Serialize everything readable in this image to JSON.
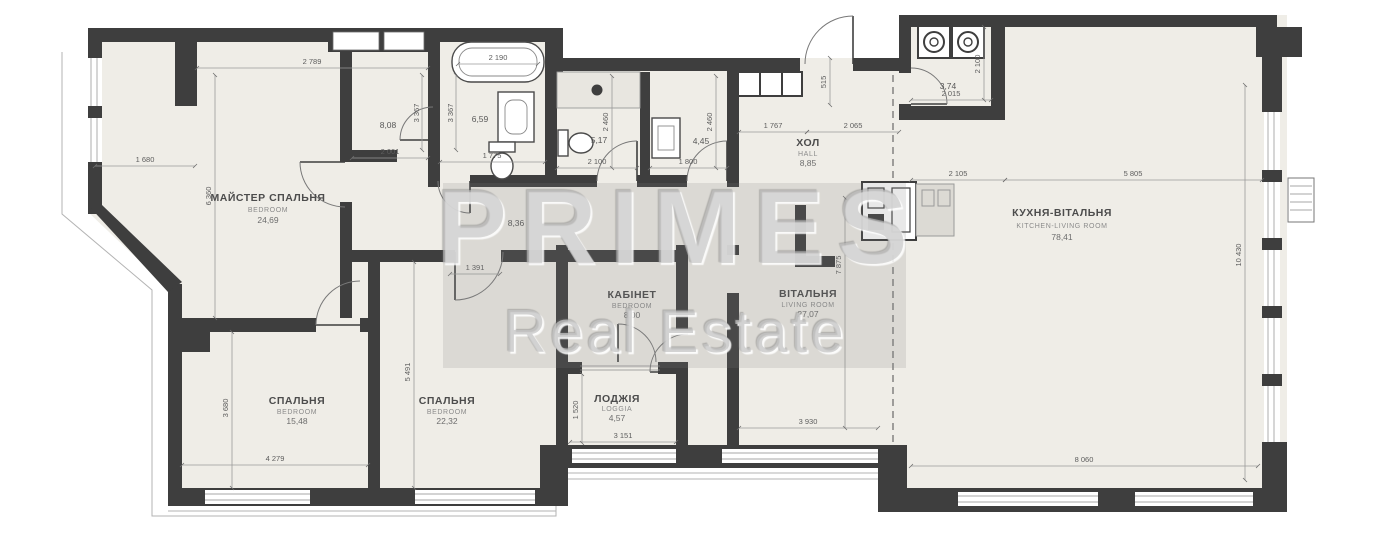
{
  "watermark": {
    "brand": "PRIMES",
    "tagline": "Real Estate"
  },
  "colors": {
    "wall": "#3e3e3e",
    "floor": "#efede7",
    "dim_text": "#5d5d5d",
    "watermark_gray": "#c4c4c4"
  },
  "rooms": {
    "master": {
      "name": "МАЙСТЕР СПАЛЬНЯ",
      "type": "BEDROOM",
      "area": "24,69"
    },
    "bedroom_small": {
      "name": "СПАЛЬНЯ",
      "type": "BEDROOM",
      "area": "15,48"
    },
    "bedroom_large": {
      "name": "СПАЛЬНЯ",
      "type": "BEDROOM",
      "area": "22,32"
    },
    "cabinet": {
      "name": "КАБІНЕТ",
      "type": "BEDROOM",
      "area": "8,00"
    },
    "loggia": {
      "name": "ЛОДЖІЯ",
      "type": "LOGGIA",
      "area": "4,57"
    },
    "hall": {
      "name": "ХОЛ",
      "type": "HALL",
      "area": "8,85"
    },
    "living": {
      "name": "ВІТАЛЬНЯ",
      "type": "LIVING ROOM",
      "area": "27,07"
    },
    "kitchen_living": {
      "name": "КУХНЯ-ВІТАЛЬНЯ",
      "type": "KITCHEN-LIVING ROOM",
      "area": "78,41"
    },
    "bathroom_master": {
      "area": "6,59"
    },
    "bathroom": {
      "area": "5,17"
    },
    "wc": {
      "area": "4,45"
    },
    "laundry": {
      "area": "3,74"
    },
    "wardrobe": {
      "area": "8,08"
    },
    "corridor": {
      "area": "8,36"
    }
  },
  "dimensions": {
    "master_width": "2 789",
    "master_bay": "1 680",
    "master_depth": "6 360",
    "wardrobe_width": "2 001",
    "wardrobe_depth_left": "3 367",
    "wardrobe_depth_right": "3 367",
    "bath_master_width": "1 775",
    "tub_width": "2 190",
    "bathroom_width": "2 100",
    "bathroom_depth": "2 460",
    "wc_width": "1 800",
    "wc_depth": "2 460",
    "hall_width_left": "1 767",
    "hall_width_right": "2 065",
    "hall_niche": "515",
    "laundry_width": "2 015",
    "laundry_depth": "2 100",
    "kitchen_width_left": "2 105",
    "kitchen_width_right": "5 805",
    "kitchen_depth": "10 430",
    "kitchen_bottom": "8 060",
    "living_width": "3 930",
    "living_depth": "7 875",
    "loggia_width": "3 151",
    "loggia_depth": "1 520",
    "bedroom_large_depth": "5 491",
    "bedroom_small_depth": "3 680",
    "bedroom_small_width": "4 279",
    "corridor_pass": "1 391"
  }
}
